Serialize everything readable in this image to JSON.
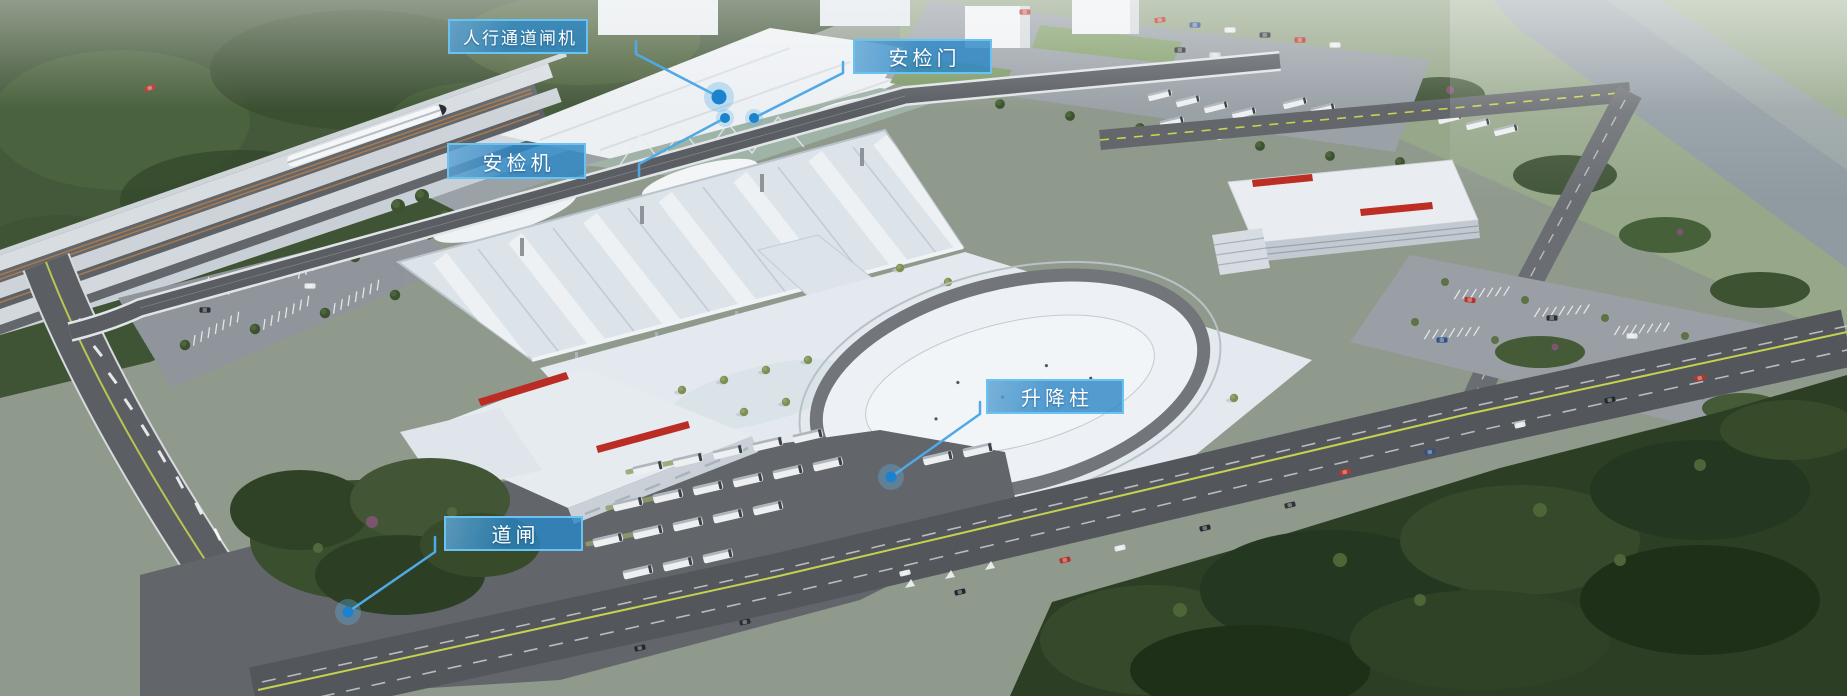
{
  "scene": {
    "type": "aerial-architectural-rendering",
    "subject": "railway-station-transport-hub"
  },
  "callouts": {
    "pedestrian_gate": {
      "label": "人行通道闸机"
    },
    "security_door": {
      "label": "安检门"
    },
    "security_scanner": {
      "label": "安检机"
    },
    "lifting_bollard": {
      "label": "升降柱"
    },
    "road_barrier": {
      "label": "道闸"
    }
  },
  "colors": {
    "label_bg": "#2986C5",
    "label_border": "#69C2F0",
    "label_text": "#FFFFFF",
    "connector": "#4FA9E6",
    "dot": "#1B82CE",
    "dot_halo": "#63B5E8"
  }
}
